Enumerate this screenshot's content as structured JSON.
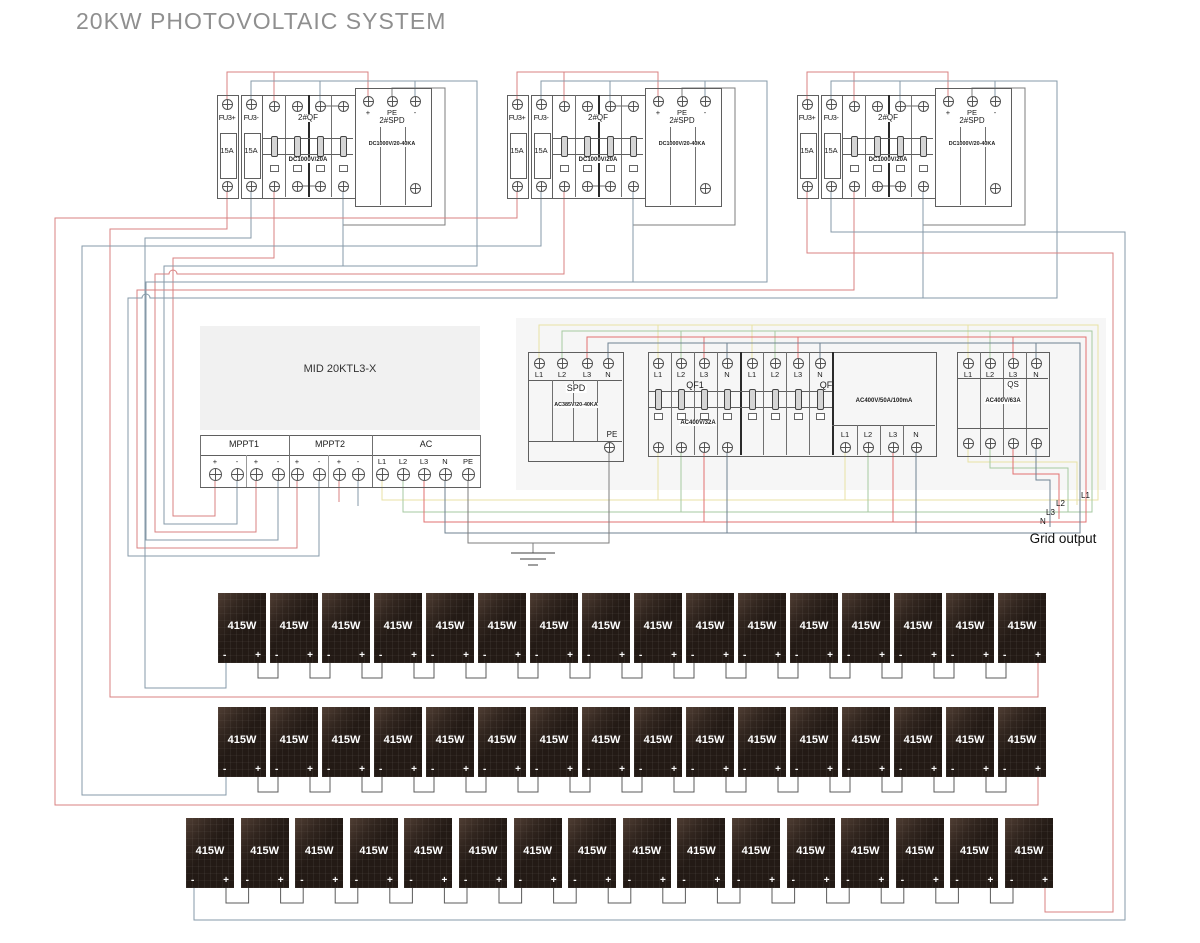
{
  "title": "20KW PHOTOVOLTAIC SYSTEM",
  "combiner_group": {
    "fuse_pos_label": "FU3+",
    "fuse_neg_label": "FU3-",
    "fuse_rating": "15A",
    "breaker_label": "2#QF",
    "breaker_rating": "DC1000V/20A",
    "spd_label": "2#SPD",
    "spd_rating": "DC1000V/20-40KA",
    "spd_terminals": [
      "+",
      "PE",
      "-"
    ]
  },
  "inverter": {
    "model": "MID 20KTL3-X",
    "sections": [
      {
        "label": "MPPT1",
        "terminals": [
          "+",
          "-",
          "+",
          "-"
        ]
      },
      {
        "label": "MPPT2",
        "terminals": [
          "+",
          "-",
          "+",
          "-"
        ]
      },
      {
        "label": "AC",
        "terminals": [
          "L1",
          "L2",
          "L3",
          "N",
          "PE"
        ]
      }
    ]
  },
  "ac_spd": {
    "label": "SPD",
    "rating": "AC385V/20-40KA",
    "terminals": [
      "L1",
      "L2",
      "L3",
      "N"
    ],
    "pe_label": "PE"
  },
  "qf1": {
    "label": "QF1",
    "rating": "AC400V/32A",
    "terminals": [
      "L1",
      "L2",
      "L3",
      "N"
    ]
  },
  "qf": {
    "label": "QF",
    "rating": "AC400V/50A/100mA",
    "terminals": [
      "L1",
      "L2",
      "L3",
      "N"
    ],
    "bottom_terminals": [
      "L1",
      "L2",
      "L3",
      "N"
    ]
  },
  "qs": {
    "label": "QS",
    "rating": "AC400V/63A",
    "terminals": [
      "L1",
      "L2",
      "L3",
      "N"
    ]
  },
  "grid_output": {
    "label": "Grid output",
    "wire_labels": [
      "L1",
      "L2",
      "L3",
      "N"
    ]
  },
  "pv": {
    "panel_power": "415W",
    "neg": "-",
    "pos": "+",
    "rows": 3,
    "panels_per_row": 16
  },
  "colors": {
    "title_gray": "#8f8f8f",
    "dc_positive_wire": "#d98181",
    "dc_negative_wire": "#869aa8",
    "pe_wire": "#7d7d7d",
    "ac_l1_wire": "#e8e2a4",
    "ac_l2_wire": "#a6c9a0",
    "ac_l3_wire": "#e27070",
    "ac_n_wire": "#6f8292",
    "panel_body": "#231a15",
    "inverter_body": "#f1f1f1",
    "box_border": "#5f5f5f"
  }
}
